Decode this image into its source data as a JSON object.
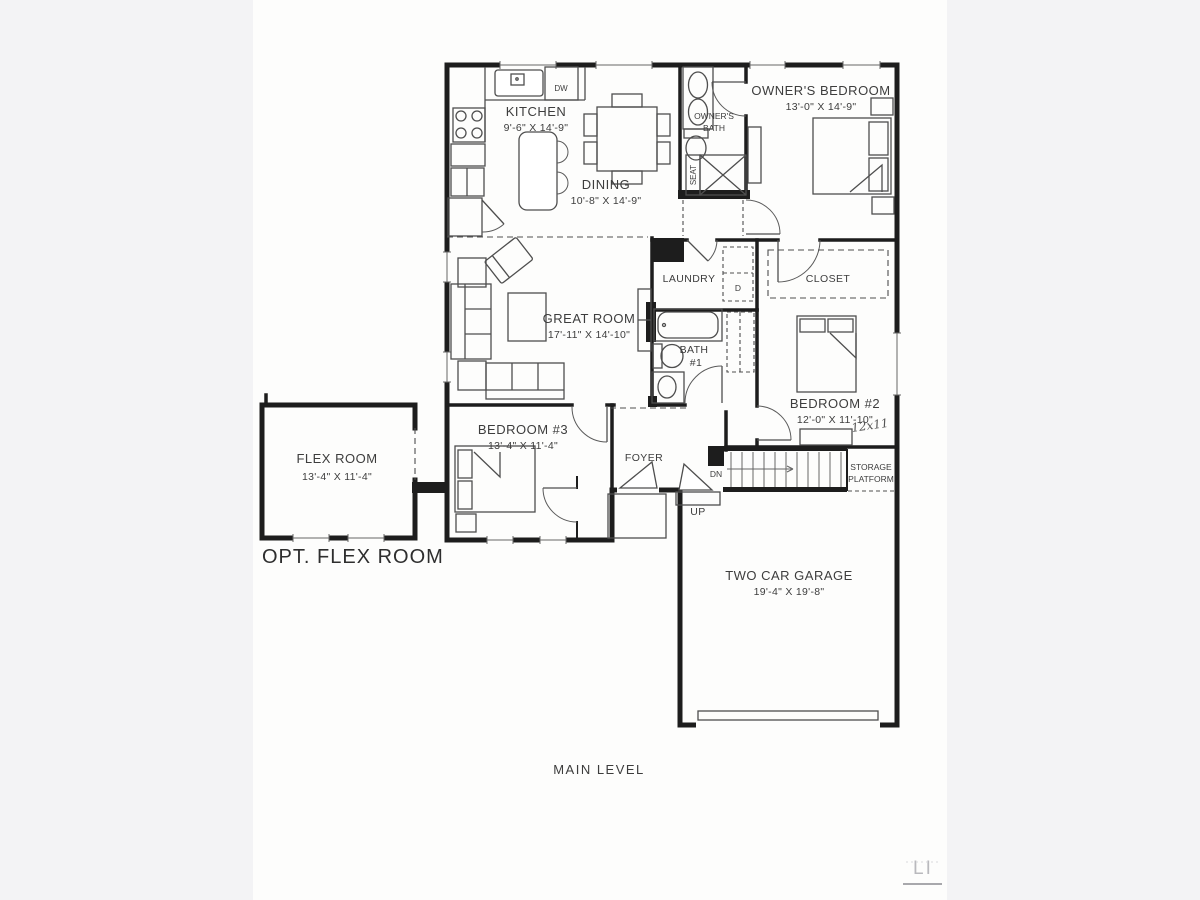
{
  "captions": {
    "plan_level": "MAIN LEVEL",
    "optional_room": "OPT. FLEX ROOM"
  },
  "rooms": {
    "kitchen": {
      "name": "KITCHEN",
      "dims": "9'-6\" X 14'-9\""
    },
    "dining": {
      "name": "DINING",
      "dims": "10'-8\" X 14'-9\""
    },
    "owners_bedroom": {
      "name": "OWNER'S BEDROOM",
      "dims": "13'-0\" X 14'-9\""
    },
    "owners_bath": {
      "line1": "OWNER'S",
      "line2": "BATH"
    },
    "great_room": {
      "name": "GREAT ROOM",
      "dims": "17'-11\" X 14'-10\""
    },
    "laundry": {
      "name": "LAUNDRY"
    },
    "closet": {
      "name": "CLOSET"
    },
    "bath1": {
      "line1": "BATH",
      "line2": "#1"
    },
    "bedroom2": {
      "name": "BEDROOM #2",
      "dims": "12'-0\" X 11'-10\"",
      "handwritten_note": "12x11"
    },
    "bedroom3": {
      "name": "BEDROOM #3",
      "dims": "13'-4\" X 11'-4\""
    },
    "foyer": {
      "name": "FOYER"
    },
    "flex_room": {
      "name": "FLEX ROOM",
      "dims": "13'-4\" X 11'-4\""
    },
    "garage": {
      "name": "TWO CAR GARAGE",
      "dims": "19'-4\" X 19'-8\""
    },
    "storage_platform": {
      "line1": "STORAGE",
      "line2": "PLATFORM"
    }
  },
  "fixture_labels": {
    "dishwasher": "DW",
    "dryer": "D",
    "shower_seat": "SEAT",
    "stairs_up": "UP",
    "stairs_down": "DN"
  },
  "watermark": "LI",
  "colors": {
    "wall": "#1d1d1d",
    "line": "#4e4e4e",
    "page": "#fdfdfc",
    "margin": "#f3f3f5",
    "text": "#3d3d3d"
  }
}
